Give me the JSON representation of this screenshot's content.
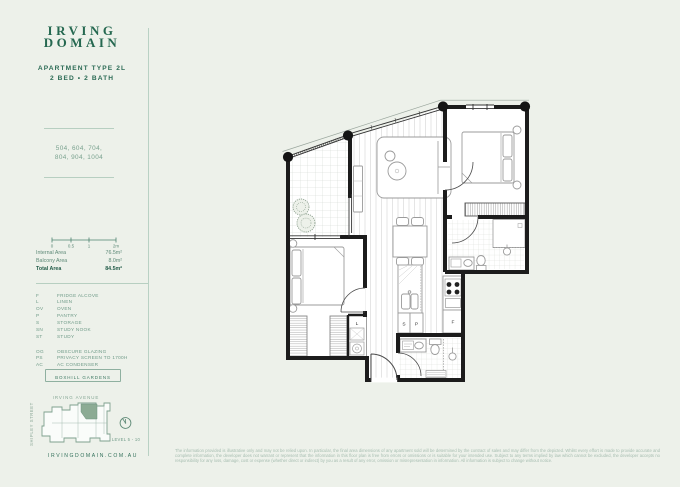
{
  "brand": {
    "name_line1": "IRVING",
    "name_line2": "DOMAIN"
  },
  "header": {
    "apartment_type": "APARTMENT TYPE 2L",
    "bed_bath": "2 BED • 2 BATH"
  },
  "sidebar": {
    "apartment_numbers_line1": "504, 604, 704,",
    "apartment_numbers_line2": "804, 904, 1004",
    "scale_ticks": [
      "0",
      "0.5",
      "1",
      "2m"
    ],
    "areas": {
      "internal_label": "Internal Area",
      "internal_value": "76.5m²",
      "balcony_label": "Balcony Area",
      "balcony_value": "8.0m²",
      "total_label": "Total Area",
      "total_value": "84.5m²"
    },
    "legend1": [
      {
        "abbr": "F",
        "label": "FRIDGE ALCOVE"
      },
      {
        "abbr": "L",
        "label": "LINEN"
      },
      {
        "abbr": "OV",
        "label": "OVEN"
      },
      {
        "abbr": "P",
        "label": "PANTRY"
      },
      {
        "abbr": "S",
        "label": "STORAGE"
      },
      {
        "abbr": "SN",
        "label": "STUDY NOOK"
      },
      {
        "abbr": "ST",
        "label": "STUDY"
      }
    ],
    "legend2": [
      {
        "abbr": "OG",
        "label": "OBSCURE GLAZING"
      },
      {
        "abbr": "PS",
        "label": "PRIVACY SCREEN TO 1700H"
      },
      {
        "abbr": "AC",
        "label": "AC CONDENSER"
      }
    ],
    "gardens_button": "BOXHILL GARDENS",
    "avenue": "IRVING AVENUE",
    "street": "SHIPLEY STREET",
    "level": "LEVEL 5 - 10",
    "website": "IRVINGDOMAIN.COM.AU"
  },
  "plan_labels": {
    "linen": "L",
    "storage": "S",
    "pantry": "P",
    "fridge": "F"
  },
  "footer": {
    "disclaimer": "The information provided is illustrative only and may not be relied upon. In particular, the final area dimensions of any apartment sold will be determined by the contract of sales and may differ from the depicted. Whilst every effort is made to provide accurate and complete information, the developer does not warrant or represent that the information in this floor plan is free from errors or omissions or is suitable for your intended use. Subject to any terms implied by law which cannot be excluded, the developer accepts no responsibility for any loss, damage, cost or expense (whether direct or indirect) by you as a result of any error, omission or misrepresentation in information. All information is subject to change without notice."
  },
  "colors": {
    "accent_green": "#256850",
    "light_green": "#b9d1c4",
    "highlight_unit": "#8cab94"
  }
}
